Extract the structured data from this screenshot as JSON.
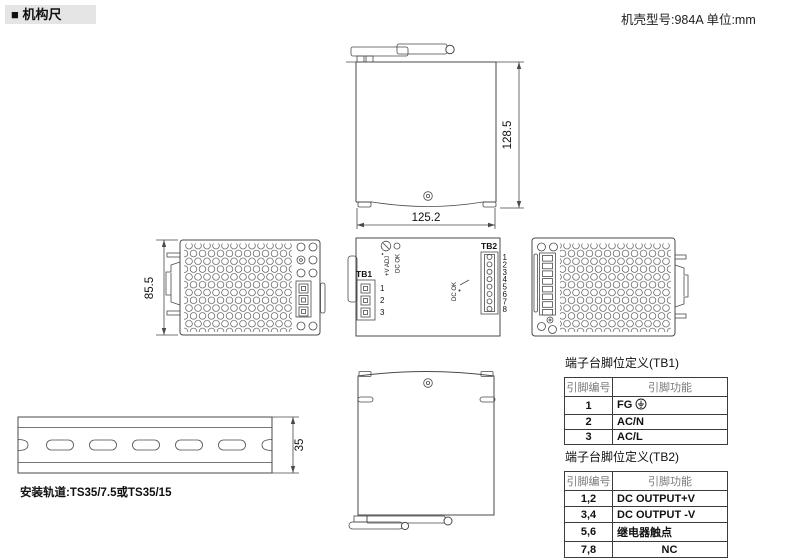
{
  "header": {
    "section_title": "■ 机构尺",
    "case_info": "机壳型号:984A 单位:mm"
  },
  "drawings": {
    "side_view": {
      "height_dim": "128.5",
      "width_dim": "125.2"
    },
    "left_side_view": {
      "height_dim": "85.5"
    },
    "front_view": {
      "tb1_label": "TB1",
      "tb2_label": "TB2",
      "vadj_label": "+V ADJ",
      "dcok_label": "DC OK",
      "relay_label": "DC OK",
      "tb1_pins": [
        "1",
        "2",
        "3"
      ],
      "tb2_pins": [
        "1",
        "2",
        "3",
        "4",
        "5",
        "6",
        "7",
        "8"
      ]
    },
    "din_rail": {
      "rail_width_dim": "35",
      "caption": "安装轨道:TS35/7.5或TS35/15"
    }
  },
  "tables": {
    "tb1": {
      "title": "端子台脚位定义(TB1)",
      "col_pin": "引脚编号",
      "col_func": "引脚功能",
      "rows": [
        {
          "pin": "1",
          "func": "FG",
          "icon": "earth-ground-icon"
        },
        {
          "pin": "2",
          "func": "AC/N"
        },
        {
          "pin": "3",
          "func": "AC/L"
        }
      ]
    },
    "tb2": {
      "title": "端子台脚位定义(TB2)",
      "col_pin": "引脚编号",
      "col_func": "引脚功能",
      "rows": [
        {
          "pin": "1,2",
          "func": "DC OUTPUT+V"
        },
        {
          "pin": "3,4",
          "func": "DC OUTPUT -V"
        },
        {
          "pin": "5,6",
          "func": "继电器触点"
        },
        {
          "pin": "7,8",
          "func": "NC"
        }
      ]
    }
  },
  "colors": {
    "line": "#4a4a4a",
    "header_bg": "#e5e5e5",
    "table_muted_text": "#7a7a7a"
  }
}
